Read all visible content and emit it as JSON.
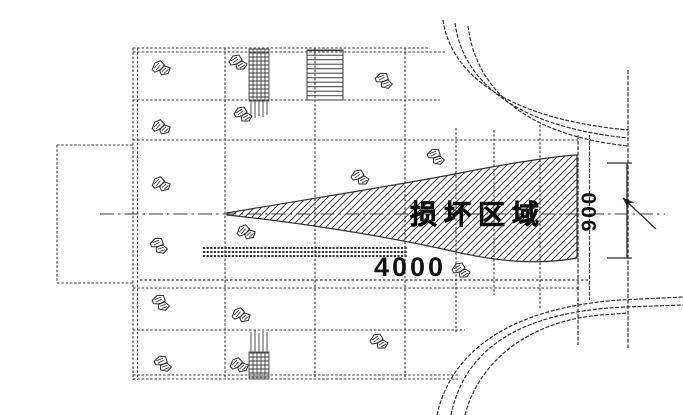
{
  "meta": {
    "drawing_type": "engineering plan (scanned blueprint)",
    "background_color": "#ffffff",
    "ink_color": "#2f2f2f",
    "text_color": "#111111"
  },
  "labels": {
    "damaged_area": "损坏区域",
    "dim_length": "4000",
    "dim_width": "900"
  },
  "drawing": {
    "rock_positions": [
      [
        160,
        68
      ],
      [
        237,
        62
      ],
      [
        383,
        80
      ],
      [
        160,
        127
      ],
      [
        242,
        114
      ],
      [
        435,
        156
      ],
      [
        160,
        184
      ],
      [
        359,
        177
      ],
      [
        158,
        245
      ],
      [
        245,
        232
      ],
      [
        460,
        270
      ],
      [
        160,
        302
      ],
      [
        240,
        315
      ],
      [
        378,
        341
      ],
      [
        162,
        363
      ],
      [
        238,
        365
      ]
    ]
  }
}
